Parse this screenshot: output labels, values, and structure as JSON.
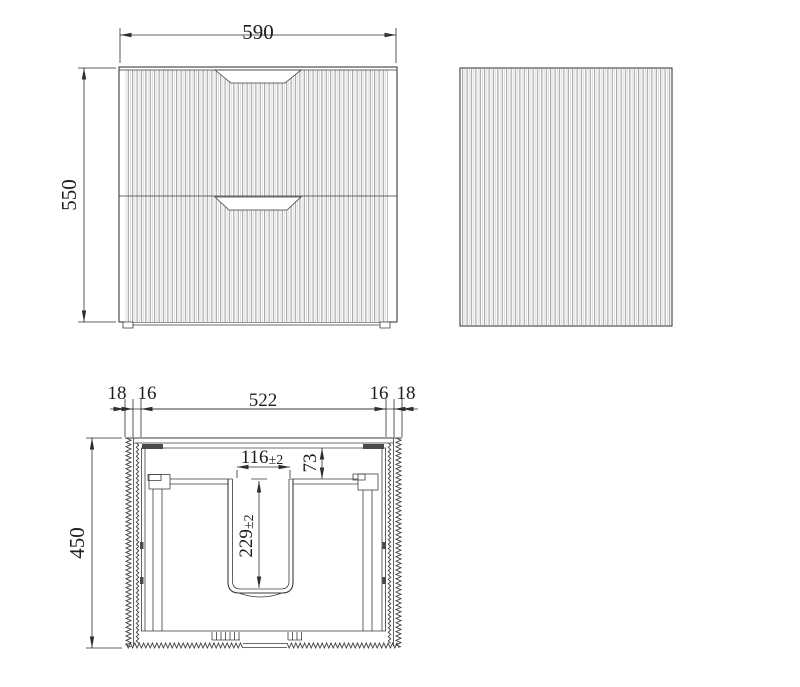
{
  "drawing": {
    "title_semantic": "vanity-cabinet-technical-drawing",
    "front_view": {
      "width_label": "590",
      "height_label": "550"
    },
    "side_view": {},
    "plan_view": {
      "depth_label": "450",
      "top_chain": [
        "18",
        "16",
        "522",
        "16",
        "18"
      ],
      "basin_cutout_width": "116",
      "basin_cutout_width_tol": "±2",
      "back_rail_offset": "73",
      "basin_cutout_depth": "229",
      "basin_cutout_depth_tol": "±2"
    }
  },
  "colors": {
    "line": "#3c3c3c",
    "dimension": "#2e2e2e",
    "flute": "#8f8f8f",
    "background": "#ffffff"
  }
}
